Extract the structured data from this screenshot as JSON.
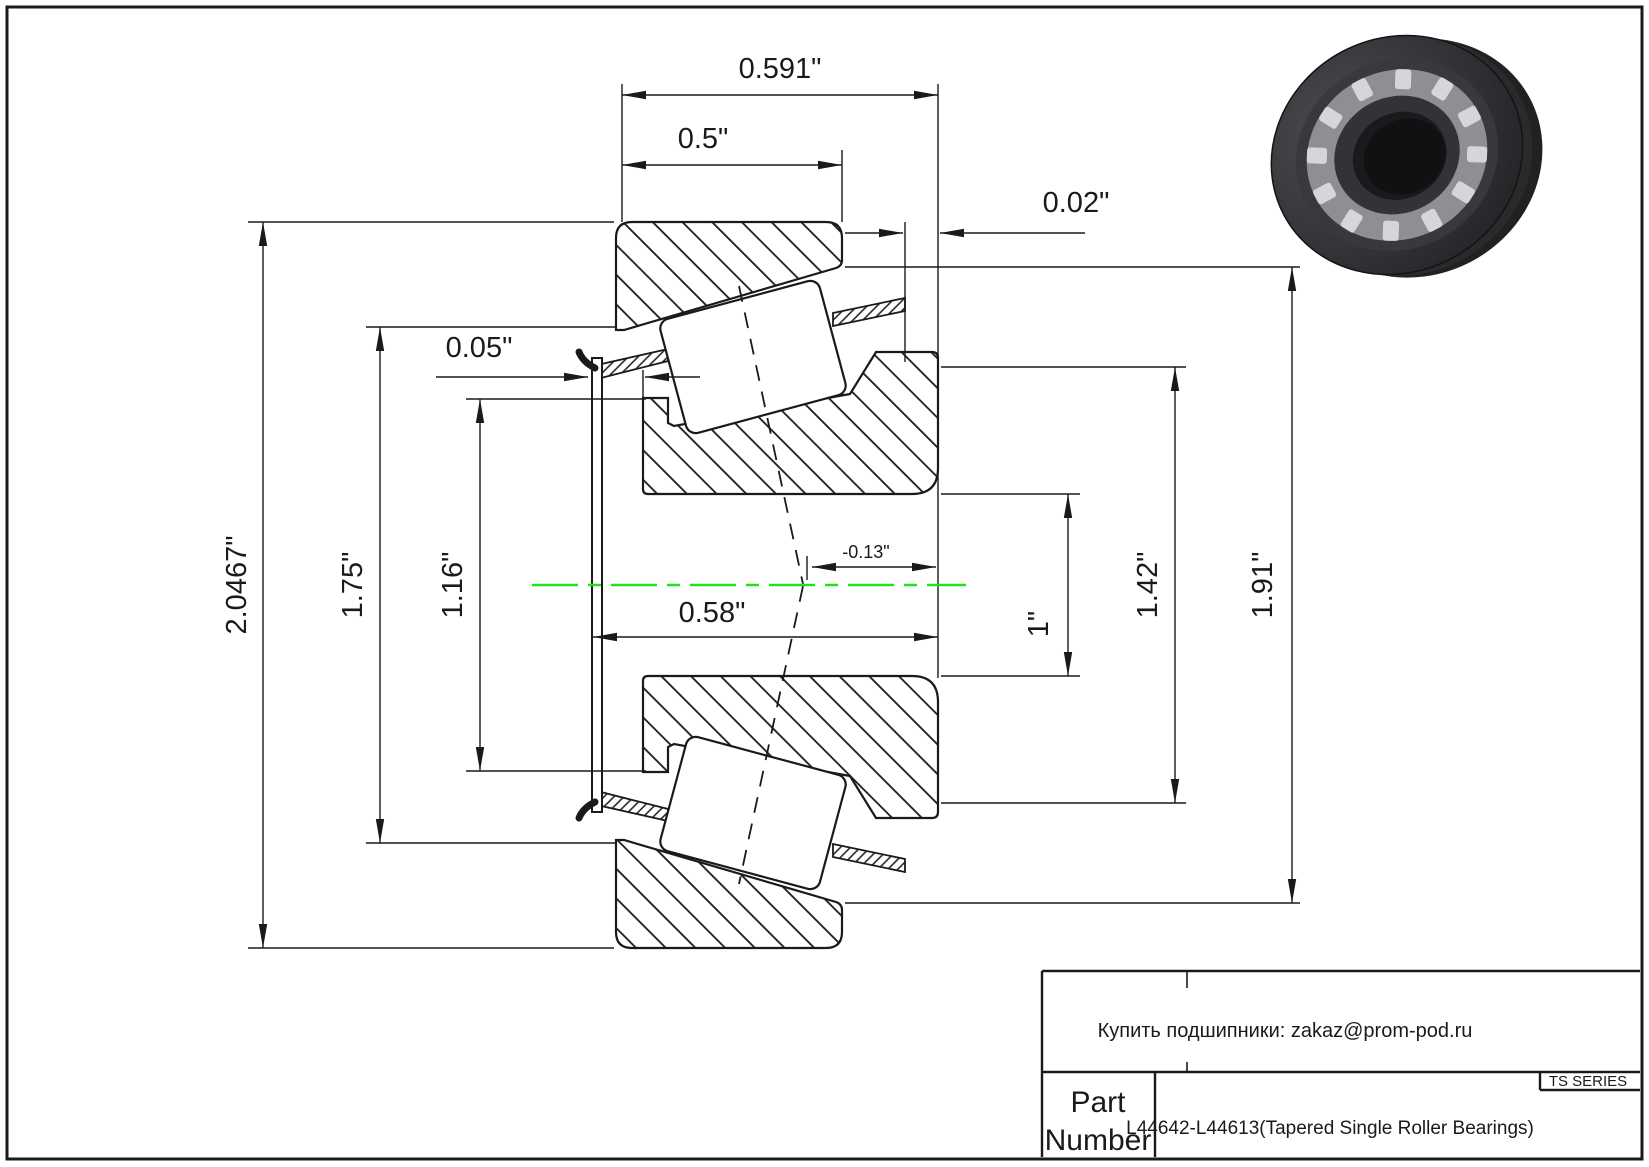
{
  "drawing_title": "Tapered roller bearing cross-section drawing",
  "colors": {
    "centerline": "#1FE11F",
    "line": "#1a1a1a",
    "background": "#ffffff"
  },
  "dims": {
    "overall_width": "0.591\"",
    "cup_width": "0.5\"",
    "standout": "0.02\"",
    "outer_diameter": "2.0467\"",
    "cup_front_id": "1.75\"",
    "cone_rib_od": "1.16\"",
    "washer_offset": "0.05\"",
    "center_width": "0.58\"",
    "eff_center": "-0.13\"",
    "bore": "1\"",
    "cone_back_od": "1.42\"",
    "cup_inner_od": "1.91\""
  },
  "title_block": {
    "shop_line": "Купить подшипники: zakaz@prom-pod.ru",
    "part_label_line1": "Part",
    "part_label_line2": "Number",
    "part_number": "L44642-L44613(Tapered Single Roller Bearings)",
    "series": "TS SERIES"
  }
}
